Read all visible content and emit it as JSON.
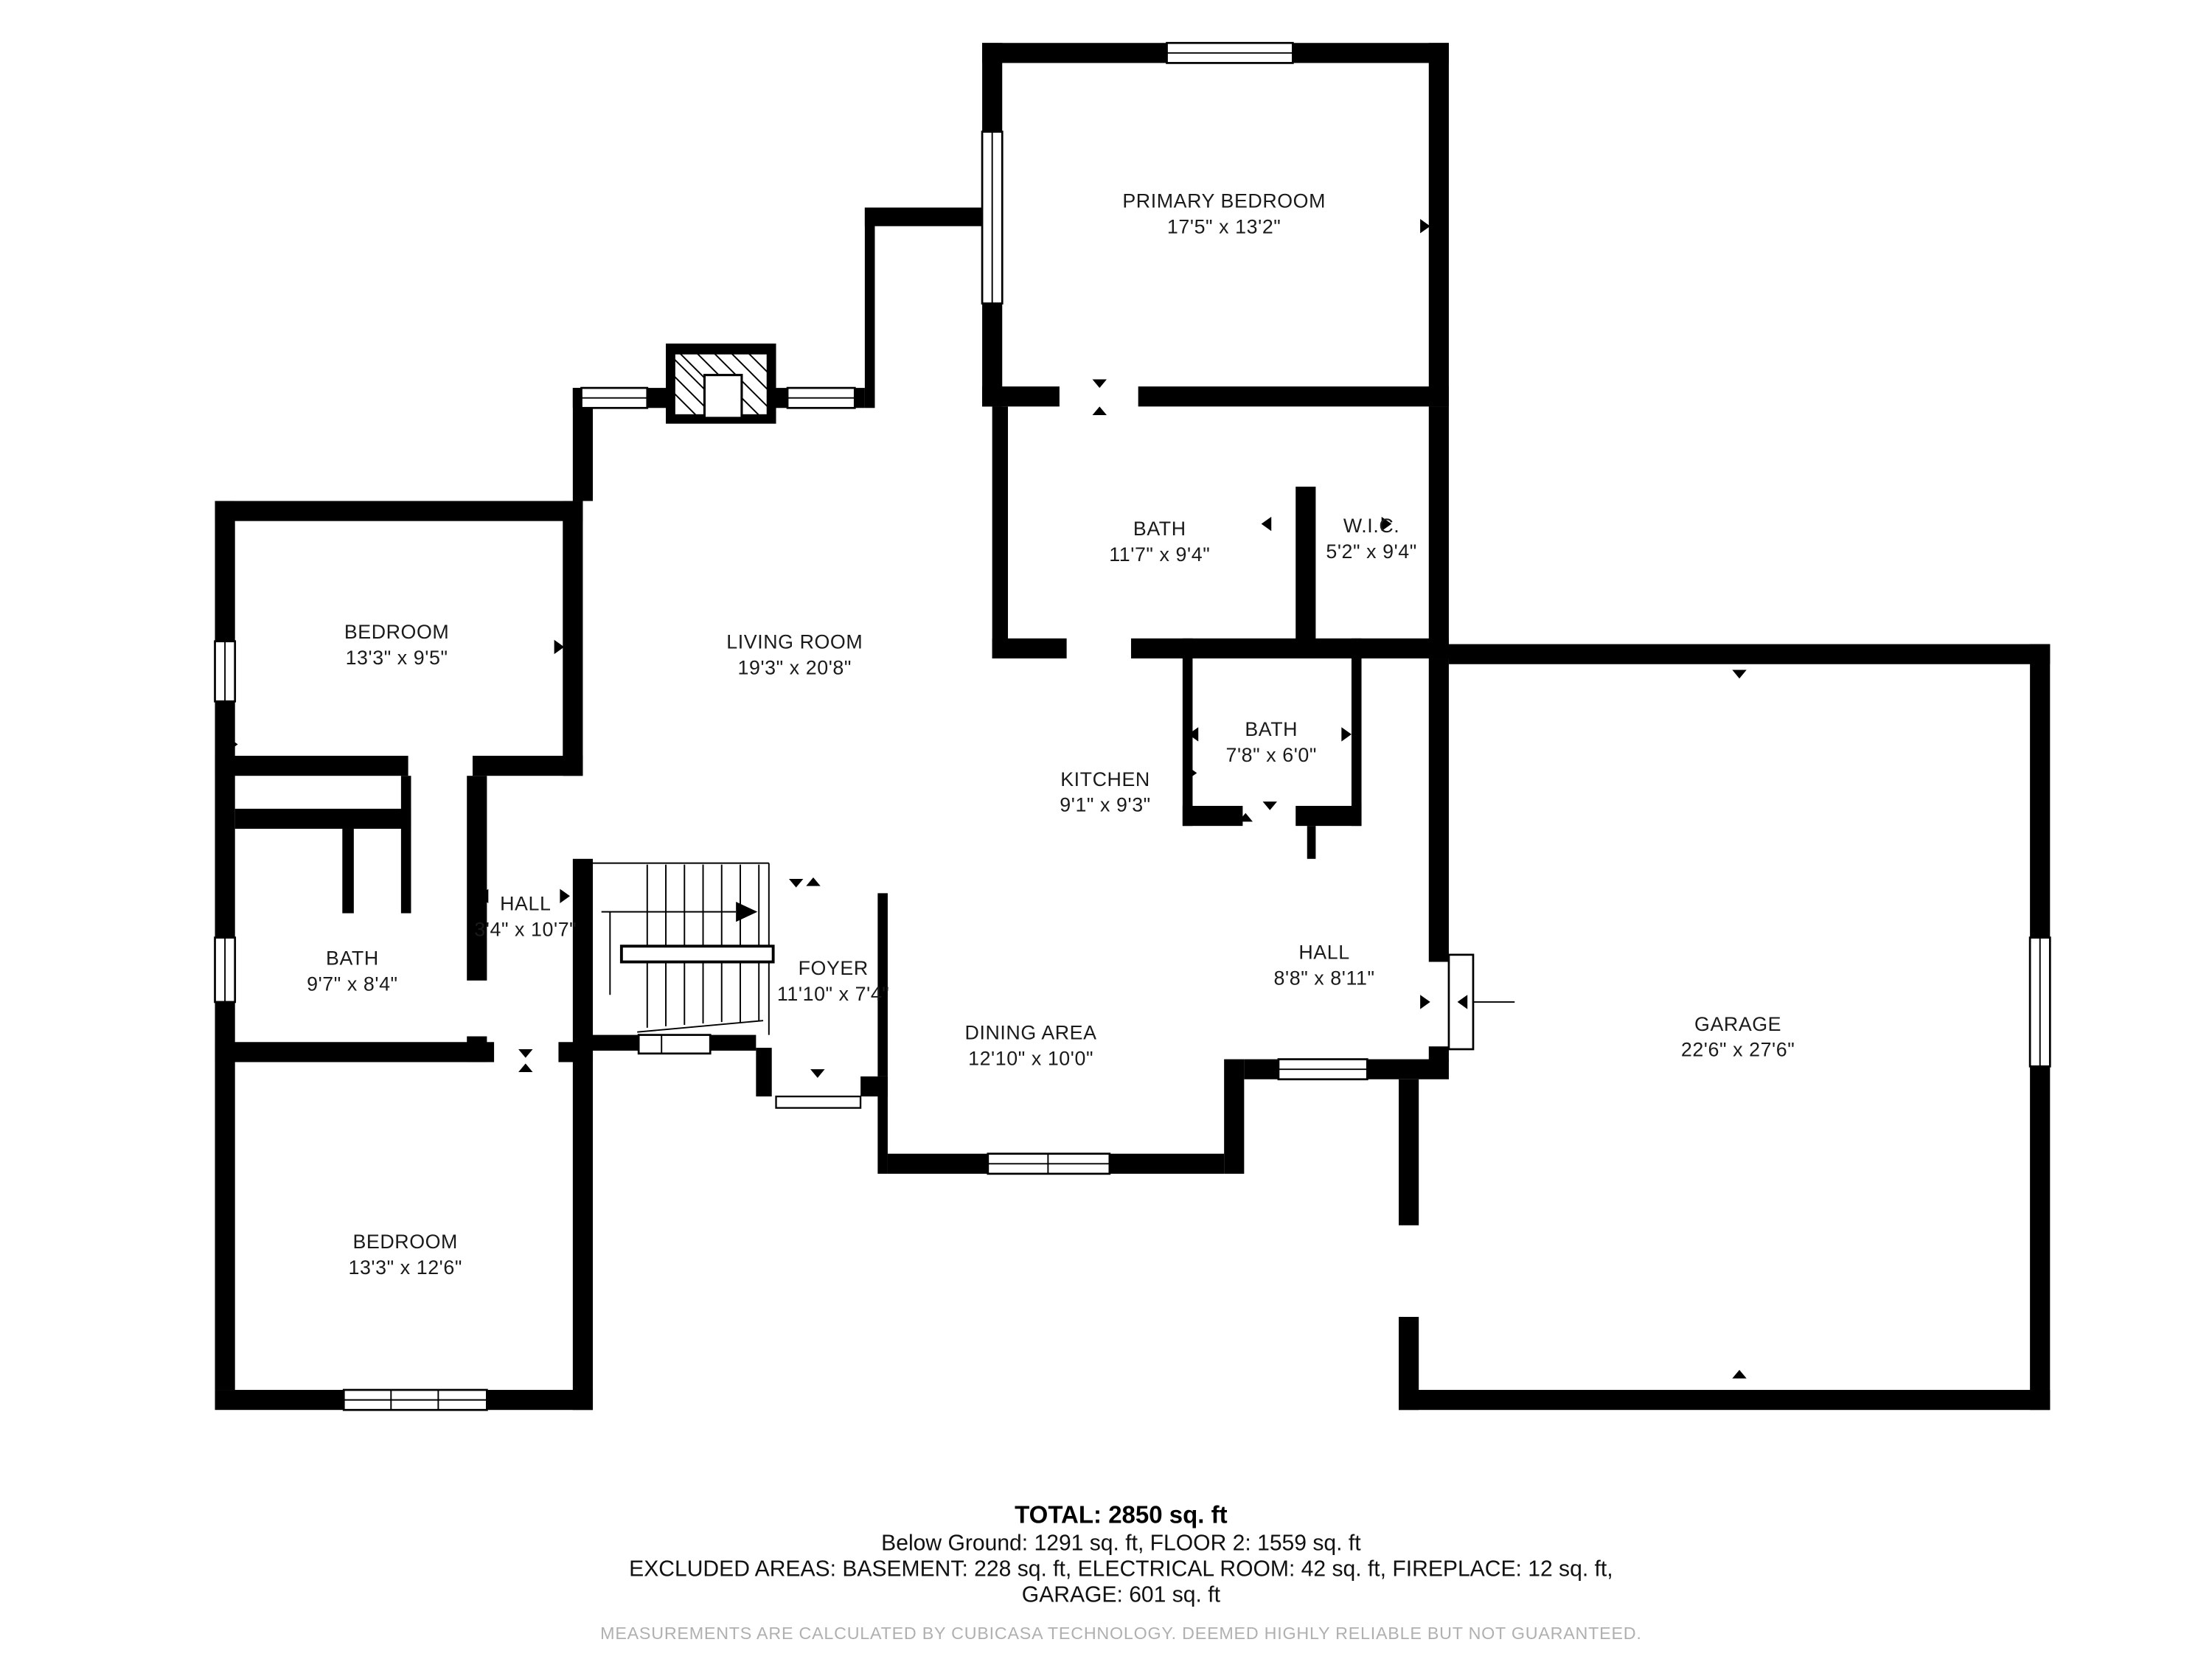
{
  "plan": {
    "rooms": {
      "primary_bedroom": {
        "name": "PRIMARY BEDROOM",
        "dims": "17'5\" x 13'2\""
      },
      "bath_upper": {
        "name": "BATH",
        "dims": "11'7\" x 9'4\""
      },
      "wic": {
        "name": "W.I.C.",
        "dims": "5'2\" x 9'4\""
      },
      "bedroom_left": {
        "name": "BEDROOM",
        "dims": "13'3\" x 9'5\""
      },
      "living_room": {
        "name": "LIVING ROOM",
        "dims": "19'3\" x 20'8\""
      },
      "kitchen": {
        "name": "KITCHEN",
        "dims": "9'1\" x 9'3\""
      },
      "bath_small": {
        "name": "BATH",
        "dims": "7'8\" x 6'0\""
      },
      "hall_left": {
        "name": "HALL",
        "dims": "3'4\" x 10'7\""
      },
      "bath_left": {
        "name": "BATH",
        "dims": "9'7\" x 8'4\""
      },
      "foyer": {
        "name": "FOYER",
        "dims": "11'10\" x 7'4\""
      },
      "dining": {
        "name": "DINING AREA",
        "dims": "12'10\" x 10'0\""
      },
      "hall_right": {
        "name": "HALL",
        "dims": "8'8\" x 8'11\""
      },
      "garage": {
        "name": "GARAGE",
        "dims": "22'6\" x 27'6\""
      },
      "bedroom_lower": {
        "name": "BEDROOM",
        "dims": "13'3\" x 12'6\""
      }
    },
    "summary": {
      "total": "TOTAL: 2850 sq. ft",
      "floors": "Below Ground: 1291 sq. ft, FLOOR 2: 1559 sq. ft",
      "excluded": "EXCLUDED AREAS: BASEMENT: 228 sq. ft, ELECTRICAL ROOM: 42 sq. ft, FIREPLACE: 12 sq. ft,",
      "excluded2": "GARAGE: 601 sq. ft",
      "disclaimer": "MEASUREMENTS ARE CALCULATED BY CUBICASA TECHNOLOGY. DEEMED HIGHLY RELIABLE BUT NOT GUARANTEED."
    },
    "colors": {
      "wall": "#000000",
      "text": "#1a1a1a",
      "disclaimer": "#b0b0b0"
    }
  }
}
